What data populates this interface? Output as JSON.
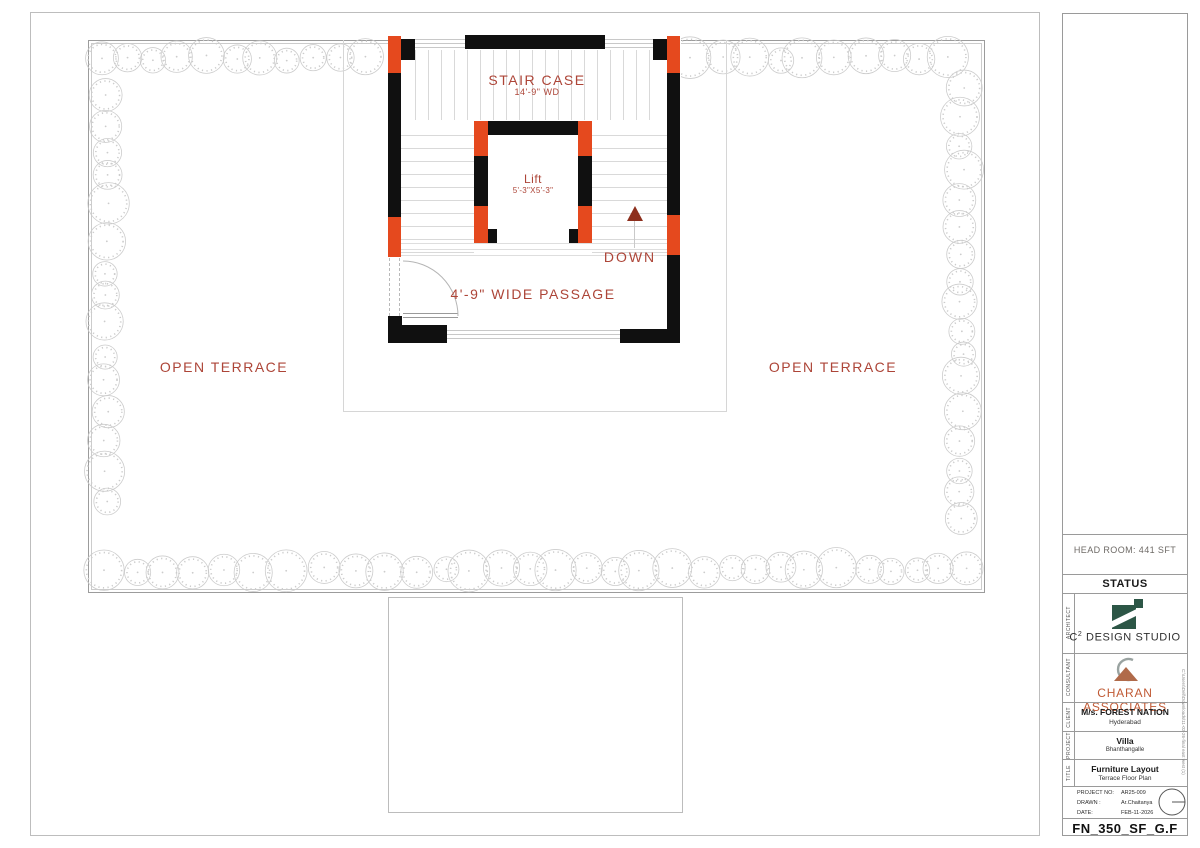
{
  "plan": {
    "stair_case_label": "STAIR CASE",
    "stair_case_dim": "14'-9\" WD",
    "lift_label": "Lift",
    "lift_dim": "5'-3\"X5'-3\"",
    "down_label": "DOWN",
    "passage_label": "4'-9\" WIDE PASSAGE",
    "open_terrace_left": "OPEN TERRACE",
    "open_terrace_right": "OPEN TERRACE",
    "colors": {
      "column_fill": "#e5491e",
      "wall_fill": "#101010",
      "annotation_text": "#ad4538",
      "down_arrow": "#8d2f1d"
    }
  },
  "title_block": {
    "head_room": "HEAD ROOM: 441 SFT",
    "status": "STATUS",
    "sections": {
      "architect": {
        "label": "ARCHITECT",
        "firm_prefix": "C",
        "firm_sup": "2",
        "firm_rest": " DESIGN STUDIO"
      },
      "consultant": {
        "label": "CONSULTANT",
        "firm": "CHARAN ASSOCIATES"
      },
      "client": {
        "label": "CLIENT",
        "name": "M/s. FOREST NATION",
        "city": "Hyderabad"
      },
      "project": {
        "label": "PROJECT",
        "name": "Villa",
        "location": "Bhanthangalle"
      },
      "title": {
        "label": "TITLE",
        "name": "Furniture Layout",
        "subtitle": "Terrace Floor Plan"
      }
    },
    "meta": {
      "project_no_label": "PROJECT NO:",
      "project_no": "AR25-009",
      "drawn_label": "DRAWN :",
      "drawn_by": "Ar.Chaitanya",
      "date_label": "DATE:",
      "date": "FEB-11-2026"
    },
    "drawing_no": "FN_350_SF_G.F",
    "file_path": "C:\\Users\\Dell\\Downloads\\11-02-26-final east west (1)",
    "colors": {
      "logo_green": "#2c5646",
      "logo_terracotta": "#b06a4a",
      "consultant_text": "#c05a35"
    }
  }
}
